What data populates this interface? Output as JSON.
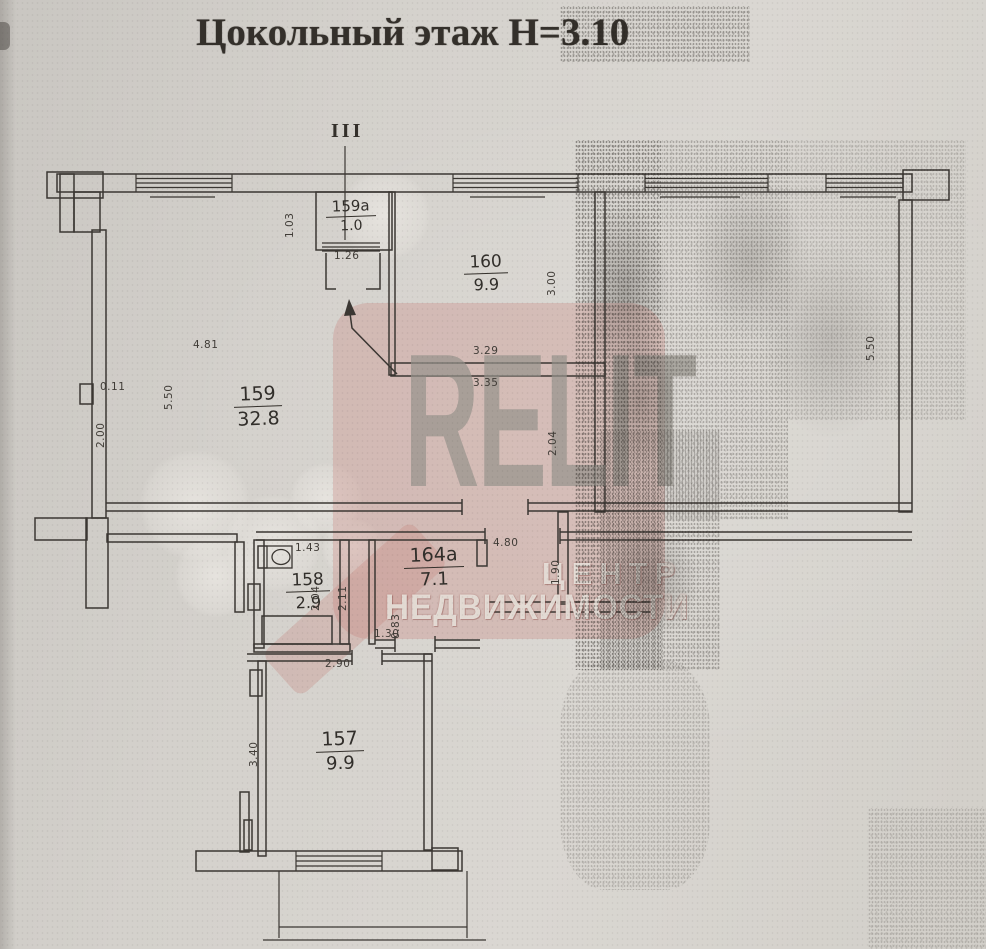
{
  "document": {
    "title": "Цокольный этаж Н=3.10",
    "entrance_marker": "III"
  },
  "rooms": {
    "r159a": {
      "number": "159а",
      "area": "1.0"
    },
    "r160": {
      "number": "160",
      "area": "9.9"
    },
    "r159": {
      "number": "159",
      "area": "32.8"
    },
    "r158": {
      "number": "158",
      "area": "2.9"
    },
    "r164a": {
      "number": "164а",
      "area": "7.1"
    },
    "r157": {
      "number": "157",
      "area": "9.9"
    }
  },
  "dimensions": {
    "d159a_h": "1.03",
    "d159a_w": "1.26",
    "d159_w": "4.81",
    "d159_h": "5.50",
    "d_notch": "0.11",
    "d159_h2": "2.00",
    "d160_w1": "3.29",
    "d160_w2": "3.35",
    "d160_h": "3.00",
    "d_mid_h": "2.04",
    "d_right_h": "5.50",
    "d_corr_w": "4.80",
    "d_corr_h": "1.90",
    "d158_w": "1.43",
    "d158_h": "2.04",
    "d164a_h": "2.11",
    "d_door_w": "1.30",
    "d_door_h": "0.83",
    "d157_w": "2.90",
    "d157_h": "3.40"
  },
  "watermark": {
    "brand": "RELIT",
    "line1": "ЦЕНТР",
    "line2": "НЕДВИЖИМОСТИ"
  },
  "colors": {
    "paper": "#d4d1cc",
    "ink": "#3b3733",
    "watermark_pink": "#c77e76",
    "watermark_gray": "#96938c"
  }
}
